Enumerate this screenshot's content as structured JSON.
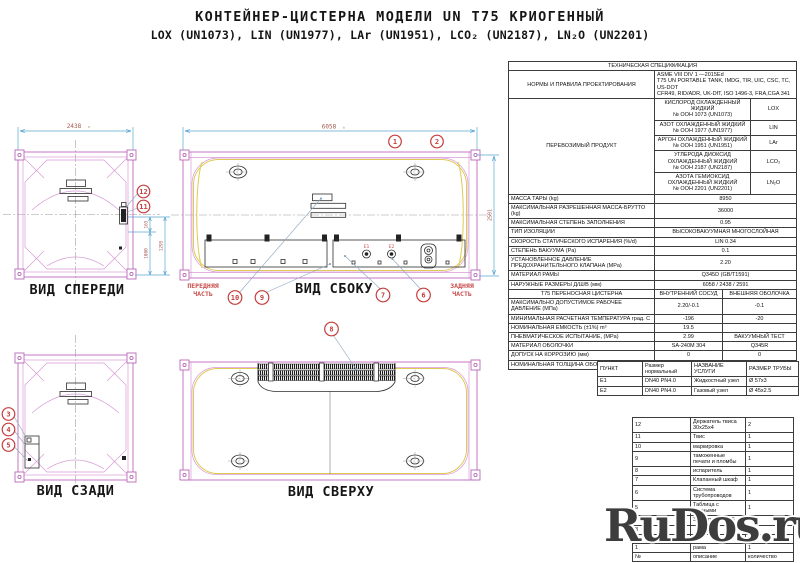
{
  "title": {
    "line1": "КОНТЕЙНЕР-ЦИСТЕРНА МОДЕЛИ UN T75 КРИОГЕННЫЙ",
    "line2": "LOX (UN1073), LIN (UN1977), LAr (UN1951), LCO₂ (UN2187), LN₂O (UN2201)"
  },
  "views": {
    "front": {
      "label": "ВИД СПЕРЕДИ",
      "dim_width": "2438",
      "dim_165": "165",
      "dim_1080": "1080",
      "dim_1295": "1295"
    },
    "rear": {
      "label": "ВИД СЗАДИ"
    },
    "side": {
      "label": "ВИД СБОКУ",
      "dim_length": "6058",
      "dim_height": "2591",
      "front_part": [
        "ПЕРЕДНЯЯ",
        "ЧАСТЬ"
      ],
      "rear_part": [
        "ЗАДНЯЯ",
        "ЧАСТЬ"
      ],
      "e1": "E1",
      "e2": "E2"
    },
    "top": {
      "label": "ВИД СВЕРХУ"
    }
  },
  "balloons": {
    "b1": "1",
    "b2": "2",
    "b3": "3",
    "b4": "4",
    "b5": "5",
    "b6": "6",
    "b7": "7",
    "b8": "8",
    "b9": "9",
    "b10": "10",
    "b11": "11",
    "b12": "12"
  },
  "tolerance_mark": "±",
  "spec": {
    "header": "ТЕХНИЧЕСКАЯ СПЕЦИФИКАЦИЯ",
    "norms_label": "НОРМЫ И ПРАВИЛА ПРОЕКТИРОВАНИЯ",
    "norms_lines": [
      "ASME VIII DIV 1 —2015Ed",
      "T75 UN PORTABLE TANK, IMDG, TIR, UIC, CSC, TC, US-DOT",
      "CFR49, RID/ADR, UK-DfT, ISO 1496-3, FRA,CGA 341"
    ],
    "product_label": "ПЕРЕВОЗИМЫЙ ПРОДУКТ",
    "products": [
      {
        "name": "КИСЛОРОД ОХЛАЖДЕННЫЙ ЖИДКИЙ",
        "un": "№ ООН 1073 (UN1073)",
        "code": "LOX"
      },
      {
        "name": "АЗОТ ОХЛАЖДЕННЫЙ ЖИДКИЙ",
        "un": "№ ООН 1977 (UN1977)",
        "code": "LIN"
      },
      {
        "name": "АРГОН ОХЛАЖДЕННЫЙ ЖИДКИЙ",
        "un": "№ ООН 1951 (UN1951)",
        "code": "LAr"
      },
      {
        "name": "УГЛЕРОДА ДИОКСИД ОХЛАЖДЕННЫЙ ЖИДКИЙ",
        "un": "№ ООН 2187 (UN2187)",
        "code": "LCO₂"
      },
      {
        "name": "АЗОТА ГЕМИОКСИД ОХЛАЖДЕННЫЙ ЖИДКИЙ",
        "un": "№ ООН 2201 (UN2201)",
        "code": "LN₂O"
      }
    ],
    "simple_rows": [
      {
        "label": "МАССА ТАРЫ (kg)",
        "value": "8950"
      },
      {
        "label": "МАКСИМАЛЬНАЯ РАЗРЕШЕННАЯ МАССА-БРУТТО (kg)",
        "value": "36000"
      },
      {
        "label": "МАКСИМАЛЬНАЯ СТЕПЕНЬ ЗАПОЛНЕНИЯ",
        "value": "0.95"
      },
      {
        "label": "ТИП ИЗОЛЯЦИИ",
        "value": "ВЫСОКОВАКУУМНАЯ МНОГОСЛОЙНАЯ"
      },
      {
        "label": "СКОРОСТЬ СТАТИЧЕСКОГО ИСПАРЕНИЯ (%/d)",
        "value": "LIN  0.34"
      },
      {
        "label": "СТЕПЕНЬ ВАКУУМА (Pa)",
        "value": "0.1"
      },
      {
        "label": "УСТАНОВЛЕННОЕ ДАВЛЕНИЕ ПРЕДОХРАНИТЕЛЬНОГО КЛАПАНА (MPa)",
        "value": "2.20"
      },
      {
        "label": "МАТЕРИАЛ РАМЫ",
        "value": "Q345D (GB/T1591)"
      },
      {
        "label": "НАРУЖНЫЕ РАЗМЕРЫ Д/Ш/В (мм)",
        "value": "6058 / 2438 / 2591"
      }
    ],
    "dual_header": {
      "label": "Т75 ПЕРЕНОСНАЯ ЦИСТЕРНА",
      "col1": "ВНУТРЕННИЙ СОСУД",
      "col2": "ВНЕШНЯЯ ОБОЛОЧКА"
    },
    "dual_rows": [
      {
        "label": "МАКСИМАЛЬНО ДОПУСТИМОЕ РАБОЧЕЕ ДАВЛЕНИЕ (МПа)",
        "inner": "2.20/-0.1",
        "outer": "-0.1"
      },
      {
        "label": "МИНИМАЛЬНАЯ РАСЧЕТНАЯ ТЕМПЕРАТУРА град. С",
        "inner": "-196",
        "outer": "-20"
      },
      {
        "label": "НОМИНАЛЬНАЯ ЕМКОСТЬ (±1%) m³",
        "inner": "19.5",
        "outer": ""
      },
      {
        "label": "ПНЕВМАТИЧЕСКОЕ ИСПЫТАНИЕ, (MPa)",
        "inner": "2.99",
        "outer": "ВАКУУМНЫЙ ТЕСТ"
      },
      {
        "label": "МАТЕРИАЛ ОБОЛОЧКИ",
        "inner": "SA-240M 304",
        "outer": "Q345R"
      },
      {
        "label": "ДОПУСК НА КОРРОЗИЮ (мм)",
        "inner": "0",
        "outer": "0"
      },
      {
        "label": "НОМИНАЛЬНАЯ ТОЛЩИНА ОБОЛОЧКИ (мм)",
        "inner": "11",
        "outer": "5"
      }
    ]
  },
  "service_table": {
    "headers": [
      "ПУНКТ",
      "Размер нормальный",
      "НАЗВАНИЕ УСЛУГИ",
      "РАЗМЕР ТРУБЫ"
    ],
    "rows": [
      {
        "item": "E1",
        "size": "DN40  PN4.0",
        "service": "Жидкостный узел",
        "pipe": "Ø 57х3"
      },
      {
        "item": "E2",
        "size": "DN40  PN4.0",
        "service": "Газовый узел",
        "pipe": "Ø 45х2.5"
      }
    ]
  },
  "parts": {
    "rows": [
      {
        "no": "12",
        "desc": "Держатель твиса 30х25х4",
        "qty": "2"
      },
      {
        "no": "11",
        "desc": "Твис",
        "qty": "1"
      },
      {
        "no": "10",
        "desc": "маркировка",
        "qty": "1"
      },
      {
        "no": "9",
        "desc": "таможенные печати и пломбы",
        "qty": "1"
      },
      {
        "no": "8",
        "desc": "испаритель",
        "qty": "1"
      },
      {
        "no": "7",
        "desc": "Клапанный шкаф",
        "qty": "1"
      },
      {
        "no": "6",
        "desc": "Система трубопроводов",
        "qty": "1"
      },
      {
        "no": "5",
        "desc": "Таблица с данными",
        "qty": "1"
      },
      {
        "no": "4",
        "desc": "Заклепка 4.8х16",
        "qty": "14"
      },
      {
        "no": "3",
        "desc": "",
        "qty": ""
      },
      {
        "no": "2",
        "desc": "",
        "qty": ""
      },
      {
        "no": "1",
        "desc": "рама",
        "qty": "1"
      }
    ],
    "footer": {
      "no": "№",
      "desc": "описание",
      "qty": "количество"
    }
  },
  "watermark": "RuDos.ru"
}
